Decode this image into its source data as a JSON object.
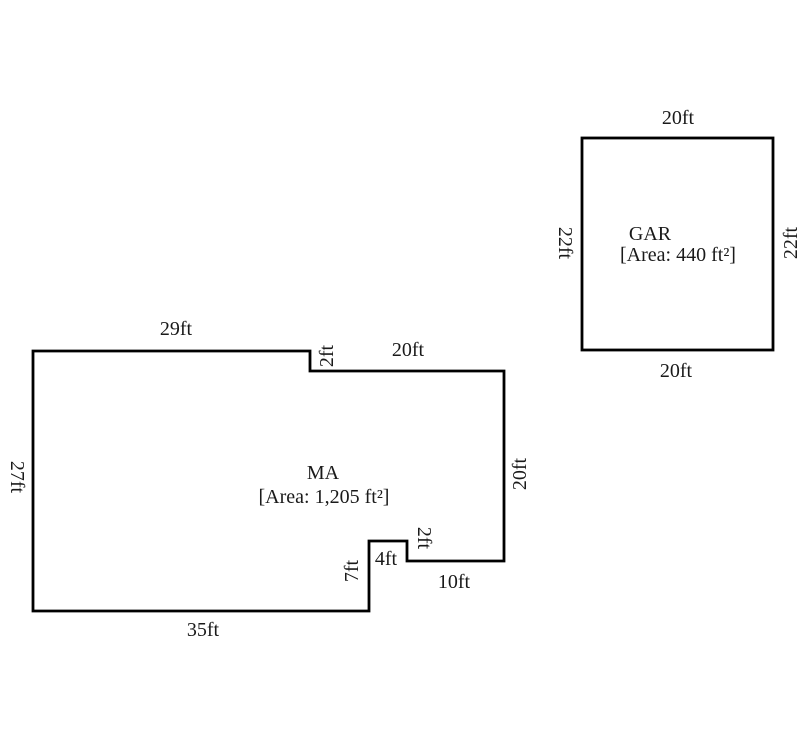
{
  "colors": {
    "background": "#ffffff",
    "line": "#000000",
    "text": "#1a1a1a"
  },
  "ma": {
    "name": "MA",
    "area": "[Area: 1,205 ft²]",
    "dim_top": "29ft",
    "dim_step": "2ft",
    "dim_top2": "20ft",
    "dim_right": "20ft",
    "dim_notch_bottom": "10ft",
    "dim_notch_side": "2ft",
    "dim_notch_top": "4ft",
    "dim_notch_left": "7ft",
    "dim_bottom": "35ft",
    "dim_left": "27ft"
  },
  "gar": {
    "name": "GAR",
    "area": "[Area: 440 ft²]",
    "dim_top": "20ft",
    "dim_bottom": "20ft",
    "dim_left": "22ft",
    "dim_right": "22ft"
  }
}
